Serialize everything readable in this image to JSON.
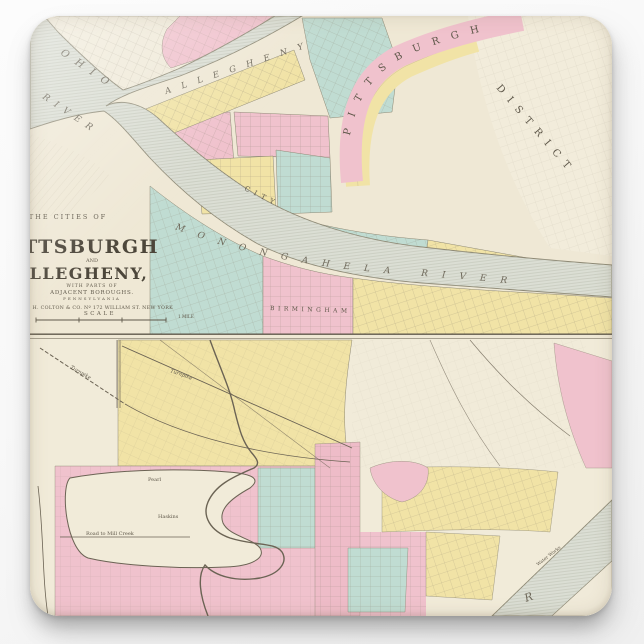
{
  "colors": {
    "background": "#fafafa",
    "paper": "#efe8d5",
    "paper_light": "#f3eee1",
    "pink": "#f0c2cd",
    "yellow": "#f1e3a6",
    "teal": "#c0dcd2",
    "river": "#dbded4",
    "ink": "#6b6354",
    "bank": "#8d8874"
  },
  "top_map": {
    "title": {
      "kicker": "THE CITIES OF",
      "city1": "PITTSBURGH",
      "conjunction": "AND",
      "city2": "ALLEGHENY,",
      "sub1": "WITH PARTS OF",
      "sub2": "ADJACENT BOROUGHS.",
      "state": "PENNSYLVANIA",
      "publisher": "J. H. COLTON & CO. Nº 172 WILLIAM ST. NEW YORK",
      "scale_label": "SCALE",
      "mile_label": "1 MILE"
    },
    "labels": {
      "ohio": "OHIO",
      "ohio_river": "RIVER",
      "allegheny": "ALLEGHENY",
      "monongahela": "MONONGAHELA RIVER",
      "pittsburgh_arc": "PITTSBURGH",
      "district": "DISTRICT",
      "city": "CITY",
      "birmingham": "BIRMINGHAM"
    }
  },
  "bottom_map": {
    "labels": {
      "turnpike_a": "Turnpike",
      "turnpike_b": "Turnpike",
      "mill_creek_road": "Road to Mill Creek",
      "pearl": "Pearl",
      "haskins": "Haskins",
      "water_works": "Water Works",
      "river_partial": "R"
    }
  }
}
